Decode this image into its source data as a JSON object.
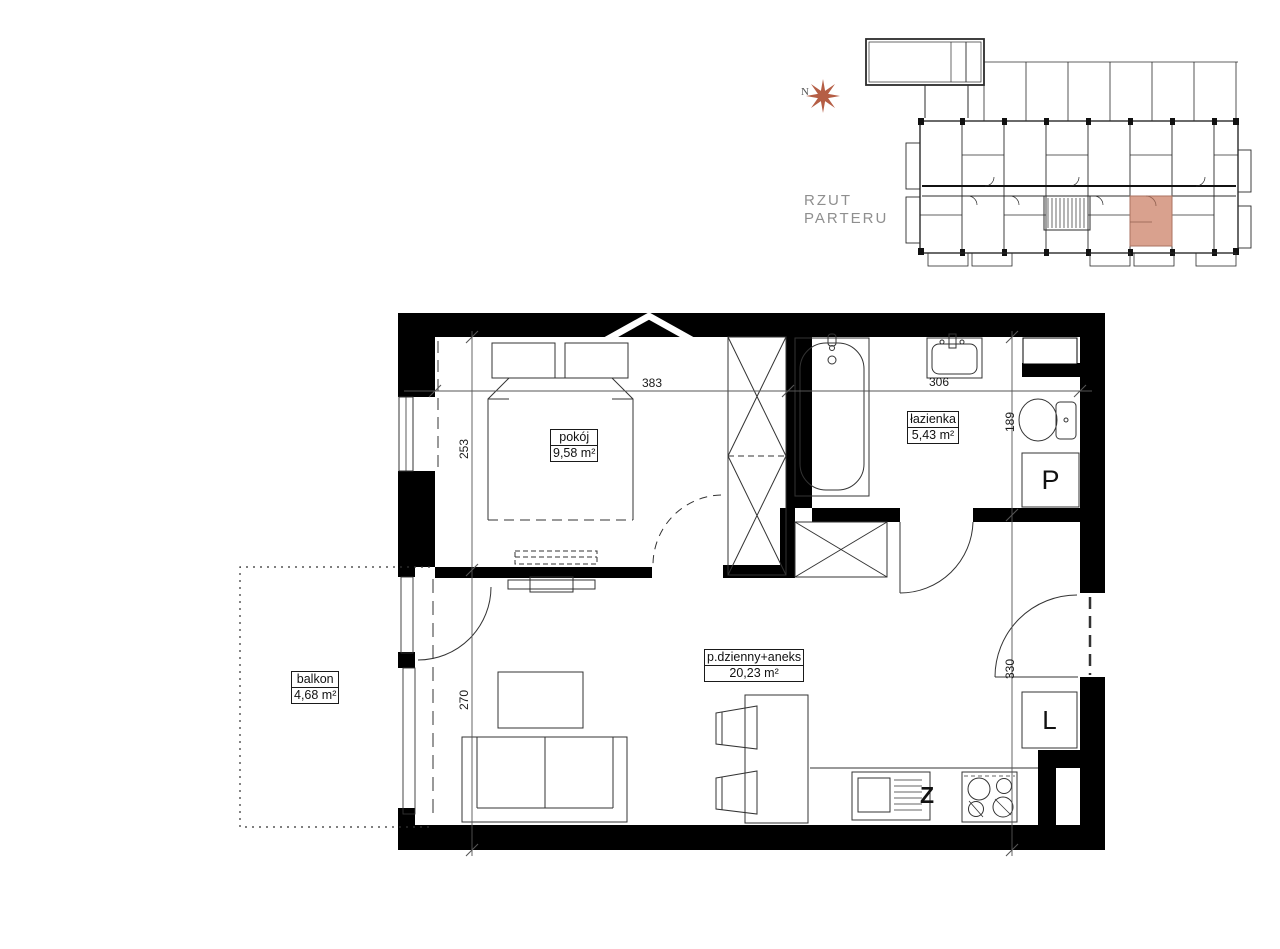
{
  "overview": {
    "north_label": "N",
    "caption": {
      "line1": "RZUT",
      "line2": "PARTERU"
    },
    "highlight_color": "#d9a18e",
    "compass_color": "#b55e45"
  },
  "plan": {
    "rooms": [
      {
        "name": "pokój",
        "area": "9,58 m²"
      },
      {
        "name": "łazienka",
        "area": "5,43 m²"
      },
      {
        "name": "p.dzienny+aneks",
        "area": "20,23 m²"
      },
      {
        "name": "balkon",
        "area": "4,68 m²"
      }
    ],
    "dimensions": {
      "bedroom_height": "253",
      "bedroom_width": "383",
      "bathroom_width": "306",
      "bathroom_height": "189",
      "living_height": "270",
      "hall_height": "330"
    },
    "appliances": {
      "washer": "P",
      "fridge": "L",
      "sink": "Z"
    }
  }
}
